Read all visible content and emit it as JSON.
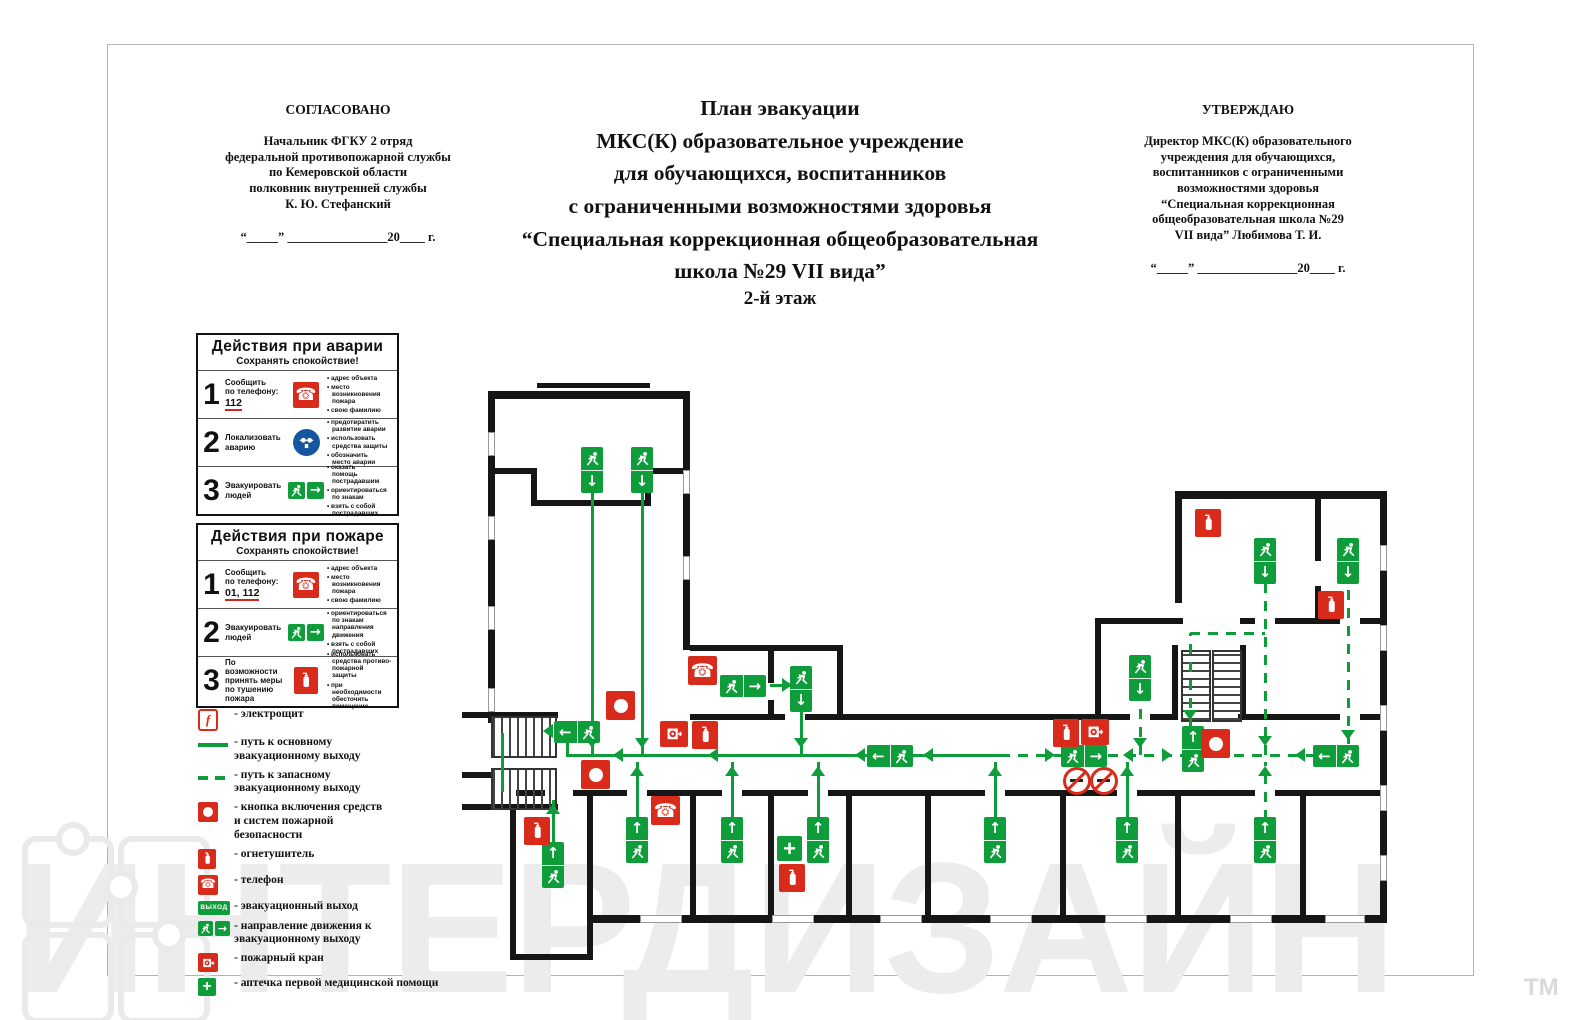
{
  "header": {
    "agree": {
      "title": "СОГЛАСОВАНО",
      "body": "Начальник ФГКУ 2 отряд\nфедеральной противопожарной службы\nпо Кемеровской области\nполковник внутренней службы\nК. Ю. Стефанский",
      "dateline": "“_____” ________________20____ г."
    },
    "title": "План эвакуации\nМКС(К) образовательное учреждение\nдля обучающихся, воспитанников\nс ограниченными возможностями здоровья\n“Специальная коррекционная общеобразовательная\nшкола №29 VII вида”",
    "floor_label": "2-й этаж",
    "approve": {
      "title": "УТВЕРЖДАЮ",
      "body": "Директор МКС(К) образовательного\nучреждения для обучающихся,\nвоспитанников с ограниченными\nвозможностями здоровья\n“Специальная коррекционная\nобщеобразовательная школа №29\nVII вида” Любимова Т. И.",
      "dateline": "“_____” ________________20____ г."
    }
  },
  "boxes": [
    {
      "title": "Действия при аварии",
      "subtitle": "Сохранять спокойствие!",
      "rows": [
        {
          "num": "1",
          "label": "Сообщить\nпо телефону:",
          "phone": "112",
          "icon": "phone",
          "bullets": [
            "адрес объекта",
            "место\nвозникновения\nпожара",
            "свою фамилию"
          ]
        },
        {
          "num": "2",
          "label": "Локализовать\nаварию",
          "phone": "",
          "icon": "mask",
          "bullets": [
            "предотвратить\nразвитие аварии",
            "использовать\nсредства защиты",
            "обозначить\nместо аварии"
          ]
        },
        {
          "num": "3",
          "label": "Эвакуировать\nлюдей",
          "phone": "",
          "icon": "exitpair",
          "bullets": [
            "оказать\nпомощь\nпострадавшим",
            "ориентироваться\nпо знакам",
            "взять с собой\nпострадавших"
          ]
        }
      ]
    },
    {
      "title": "Действия при пожаре",
      "subtitle": "Сохранять спокойствие!",
      "rows": [
        {
          "num": "1",
          "label": "Сообщить\nпо телефону:",
          "phone": "01, 112",
          "icon": "phone",
          "bullets": [
            "адрес объекта",
            "место\nвозникновения\nпожара",
            "свою фамилию"
          ]
        },
        {
          "num": "2",
          "label": "Эвакуировать\nлюдей",
          "phone": "",
          "icon": "exitpair",
          "bullets": [
            "ориентироваться\nпо знакам\nнаправления\nдвижения",
            "взять с собой\nпострадавших"
          ]
        },
        {
          "num": "3",
          "label": "По возможности\nпринять меры\nпо тушению\nпожара",
          "phone": "",
          "icon": "ext",
          "bullets": [
            "использовать\nсредства противо-\nпожарной\nзащиты",
            "при\nнеобходимости\nобесточить\nпомещение"
          ]
        }
      ]
    }
  ],
  "legend": [
    {
      "icon": "elektro",
      "label": "- электрощит"
    },
    {
      "icon": "line_solid",
      "label": "- путь к основному\nэвакуационному выходу"
    },
    {
      "icon": "line_dashed",
      "label": "- путь к запасному\nэвакуационному выходу"
    },
    {
      "icon": "button",
      "label": "- кнопка включения средств\nи систем пожарной\nбезопасности"
    },
    {
      "icon": "ext",
      "label": "- огнетушитель"
    },
    {
      "icon": "phone",
      "label": "- телефон"
    },
    {
      "icon": "vyhod",
      "label": "- эвакуационный выход"
    },
    {
      "icon": "dir",
      "label": "- направление движения к\nэвакуационному выходу"
    },
    {
      "icon": "hose",
      "label": "- пожарный кран"
    },
    {
      "icon": "aid",
      "label": "- аптечка первой медицинской помощи"
    }
  ],
  "labels": {
    "exit_badge": "ВЫХОД"
  },
  "colors": {
    "green": "#0f9d3c",
    "red": "#d92b1c",
    "wall": "#161616",
    "blue": "#1456a0"
  },
  "watermark": {
    "text": "ИНТЕРДИЗАЙН",
    "tm": "ТМ"
  },
  "plan": {
    "walls": [
      [
        537,
        383,
        113,
        5
      ],
      [
        488,
        391,
        202,
        8
      ],
      [
        488,
        391,
        7,
        332
      ],
      [
        683,
        391,
        7,
        259
      ],
      [
        488,
        468,
        48,
        6
      ],
      [
        531,
        468,
        6,
        38
      ],
      [
        531,
        500,
        120,
        6
      ],
      [
        645,
        468,
        6,
        38
      ],
      [
        645,
        468,
        45,
        6
      ],
      [
        462,
        712,
        96,
        6
      ],
      [
        462,
        772,
        30,
        6
      ],
      [
        462,
        804,
        96,
        6
      ],
      [
        510,
        804,
        6,
        156
      ],
      [
        510,
        954,
        83,
        6
      ],
      [
        587,
        893,
        6,
        67
      ],
      [
        587,
        790,
        6,
        108
      ],
      [
        516,
        790,
        29,
        6
      ],
      [
        573,
        790,
        54,
        6
      ],
      [
        647,
        790,
        75,
        6
      ],
      [
        742,
        790,
        66,
        6
      ],
      [
        828,
        790,
        157,
        6
      ],
      [
        1005,
        790,
        112,
        6
      ],
      [
        1137,
        790,
        118,
        6
      ],
      [
        1275,
        790,
        110,
        6
      ],
      [
        593,
        915,
        792,
        8
      ],
      [
        690,
        796,
        6,
        119
      ],
      [
        768,
        796,
        6,
        119
      ],
      [
        846,
        796,
        6,
        119
      ],
      [
        925,
        796,
        6,
        119
      ],
      [
        1060,
        796,
        6,
        119
      ],
      [
        1175,
        796,
        6,
        119
      ],
      [
        1300,
        796,
        6,
        119
      ],
      [
        690,
        645,
        153,
        6
      ],
      [
        837,
        645,
        6,
        75
      ],
      [
        768,
        645,
        6,
        38
      ],
      [
        768,
        700,
        6,
        20
      ],
      [
        690,
        714,
        95,
        6
      ],
      [
        805,
        714,
        290,
        6
      ],
      [
        1095,
        618,
        6,
        102
      ],
      [
        1095,
        618,
        88,
        6
      ],
      [
        1100,
        714,
        30,
        6
      ],
      [
        1150,
        714,
        28,
        6
      ],
      [
        1238,
        714,
        62,
        6
      ],
      [
        1300,
        714,
        40,
        6
      ],
      [
        1360,
        714,
        27,
        6
      ],
      [
        1172,
        645,
        6,
        75
      ],
      [
        1240,
        645,
        6,
        75
      ],
      [
        1175,
        491,
        212,
        8
      ],
      [
        1380,
        491,
        7,
        432
      ],
      [
        1175,
        491,
        7,
        112
      ],
      [
        1315,
        491,
        6,
        70
      ],
      [
        1315,
        586,
        6,
        38
      ],
      [
        1240,
        618,
        15,
        6
      ],
      [
        1275,
        618,
        65,
        6
      ],
      [
        1360,
        618,
        27,
        6
      ]
    ],
    "windows": [
      [
        488,
        432,
        7,
        24
      ],
      [
        488,
        516,
        7,
        24
      ],
      [
        488,
        606,
        7,
        24
      ],
      [
        488,
        688,
        7,
        24
      ],
      [
        683,
        470,
        7,
        24
      ],
      [
        683,
        556,
        7,
        24
      ],
      [
        1380,
        545,
        7,
        26
      ],
      [
        1380,
        625,
        7,
        26
      ],
      [
        1380,
        705,
        7,
        26
      ],
      [
        1380,
        785,
        7,
        26
      ],
      [
        1380,
        855,
        7,
        26
      ],
      [
        640,
        915,
        42,
        8
      ],
      [
        772,
        915,
        42,
        8
      ],
      [
        880,
        915,
        42,
        8
      ],
      [
        990,
        915,
        42,
        8
      ],
      [
        1105,
        915,
        42,
        8
      ],
      [
        1230,
        915,
        42,
        8
      ],
      [
        1325,
        915,
        40,
        8
      ]
    ],
    "stairs": [
      {
        "x": 491,
        "y": 716,
        "w": 62,
        "h": 38,
        "o": "v"
      },
      {
        "x": 491,
        "y": 768,
        "w": 62,
        "h": 38,
        "o": "v"
      },
      {
        "x": 1181,
        "y": 650,
        "w": 26,
        "h": 68,
        "o": "h"
      },
      {
        "x": 1212,
        "y": 650,
        "w": 26,
        "h": 68,
        "o": "h"
      }
    ],
    "solid": [
      [
        567,
        755,
        1000,
        755
      ],
      [
        567,
        733,
        567,
        757
      ],
      [
        502,
        733,
        502,
        792
      ],
      [
        592,
        492,
        592,
        755
      ],
      [
        642,
        492,
        642,
        755
      ],
      [
        801,
        710,
        801,
        755
      ],
      [
        770,
        685,
        790,
        685
      ],
      [
        637,
        762,
        637,
        820
      ],
      [
        732,
        762,
        732,
        820
      ],
      [
        818,
        762,
        818,
        820
      ],
      [
        995,
        762,
        995,
        820
      ],
      [
        1127,
        762,
        1127,
        820
      ],
      [
        553,
        800,
        553,
        845
      ]
    ],
    "dashed": [
      [
        1000,
        755,
        1315,
        755
      ],
      [
        1265,
        584,
        1265,
        755
      ],
      [
        1265,
        762,
        1265,
        820
      ],
      [
        1348,
        584,
        1348,
        744
      ],
      [
        1140,
        700,
        1140,
        755
      ],
      [
        1190,
        633,
        1190,
        726
      ],
      [
        1190,
        633,
        1265,
        633
      ]
    ],
    "arrows": [
      {
        "d": "l",
        "x": 615,
        "y": 755
      },
      {
        "d": "l",
        "x": 710,
        "y": 755
      },
      {
        "d": "l",
        "x": 857,
        "y": 755
      },
      {
        "d": "l",
        "x": 925,
        "y": 755
      },
      {
        "d": "l",
        "x": 1125,
        "y": 755
      },
      {
        "d": "l",
        "x": 1297,
        "y": 755
      },
      {
        "d": "l",
        "x": 545,
        "y": 731
      },
      {
        "d": "r",
        "x": 1053,
        "y": 755
      },
      {
        "d": "r",
        "x": 1170,
        "y": 755
      },
      {
        "d": "r",
        "x": 790,
        "y": 685
      },
      {
        "d": "d",
        "x": 592,
        "y": 746
      },
      {
        "d": "d",
        "x": 642,
        "y": 746
      },
      {
        "d": "d",
        "x": 801,
        "y": 746
      },
      {
        "d": "d",
        "x": 1140,
        "y": 746
      },
      {
        "d": "d",
        "x": 1265,
        "y": 744
      },
      {
        "d": "d",
        "x": 1348,
        "y": 738
      },
      {
        "d": "d",
        "x": 1190,
        "y": 718
      },
      {
        "d": "u",
        "x": 637,
        "y": 768
      },
      {
        "d": "u",
        "x": 732,
        "y": 768
      },
      {
        "d": "u",
        "x": 818,
        "y": 768
      },
      {
        "d": "u",
        "x": 995,
        "y": 768
      },
      {
        "d": "u",
        "x": 1127,
        "y": 768
      },
      {
        "d": "u",
        "x": 1265,
        "y": 768
      },
      {
        "d": "u",
        "x": 553,
        "y": 806
      }
    ],
    "markers": [
      {
        "t": "sv",
        "x": 581,
        "y": 447
      },
      {
        "t": "sv",
        "x": 631,
        "y": 447
      },
      {
        "t": "sv",
        "x": 790,
        "y": 666
      },
      {
        "t": "sv",
        "x": 1129,
        "y": 655
      },
      {
        "t": "sv",
        "x": 1254,
        "y": 538
      },
      {
        "t": "sv",
        "x": 1337,
        "y": 538
      },
      {
        "t": "su",
        "x": 626,
        "y": 817
      },
      {
        "t": "su",
        "x": 721,
        "y": 817
      },
      {
        "t": "su",
        "x": 807,
        "y": 817
      },
      {
        "t": "su",
        "x": 984,
        "y": 817
      },
      {
        "t": "su",
        "x": 1116,
        "y": 817
      },
      {
        "t": "su",
        "x": 1254,
        "y": 817
      },
      {
        "t": "su",
        "x": 542,
        "y": 842
      },
      {
        "t": "su",
        "x": 1182,
        "y": 726
      },
      {
        "t": "hl",
        "x": 554,
        "y": 721
      },
      {
        "t": "hl",
        "x": 867,
        "y": 745
      },
      {
        "t": "hl",
        "x": 1313,
        "y": 745
      },
      {
        "t": "hr",
        "x": 720,
        "y": 675
      },
      {
        "t": "hr",
        "x": 1061,
        "y": 745
      },
      {
        "t": "ext",
        "x": 524,
        "y": 817
      },
      {
        "t": "ext",
        "x": 692,
        "y": 721
      },
      {
        "t": "ext",
        "x": 779,
        "y": 864
      },
      {
        "t": "ext",
        "x": 1053,
        "y": 719
      },
      {
        "t": "ext",
        "x": 1195,
        "y": 509
      },
      {
        "t": "ext",
        "x": 1318,
        "y": 591
      },
      {
        "t": "phone",
        "x": 688,
        "y": 656
      },
      {
        "t": "phone",
        "x": 651,
        "y": 796
      },
      {
        "t": "hose",
        "x": 660,
        "y": 721
      },
      {
        "t": "hose",
        "x": 1081,
        "y": 719
      },
      {
        "t": "button",
        "x": 606,
        "y": 691
      },
      {
        "t": "button",
        "x": 581,
        "y": 760
      },
      {
        "t": "button",
        "x": 1201,
        "y": 729
      },
      {
        "t": "aid",
        "x": 777,
        "y": 836
      },
      {
        "t": "nosmoke",
        "x": 1063,
        "y": 767
      },
      {
        "t": "nosmoke",
        "x": 1090,
        "y": 767
      }
    ]
  }
}
